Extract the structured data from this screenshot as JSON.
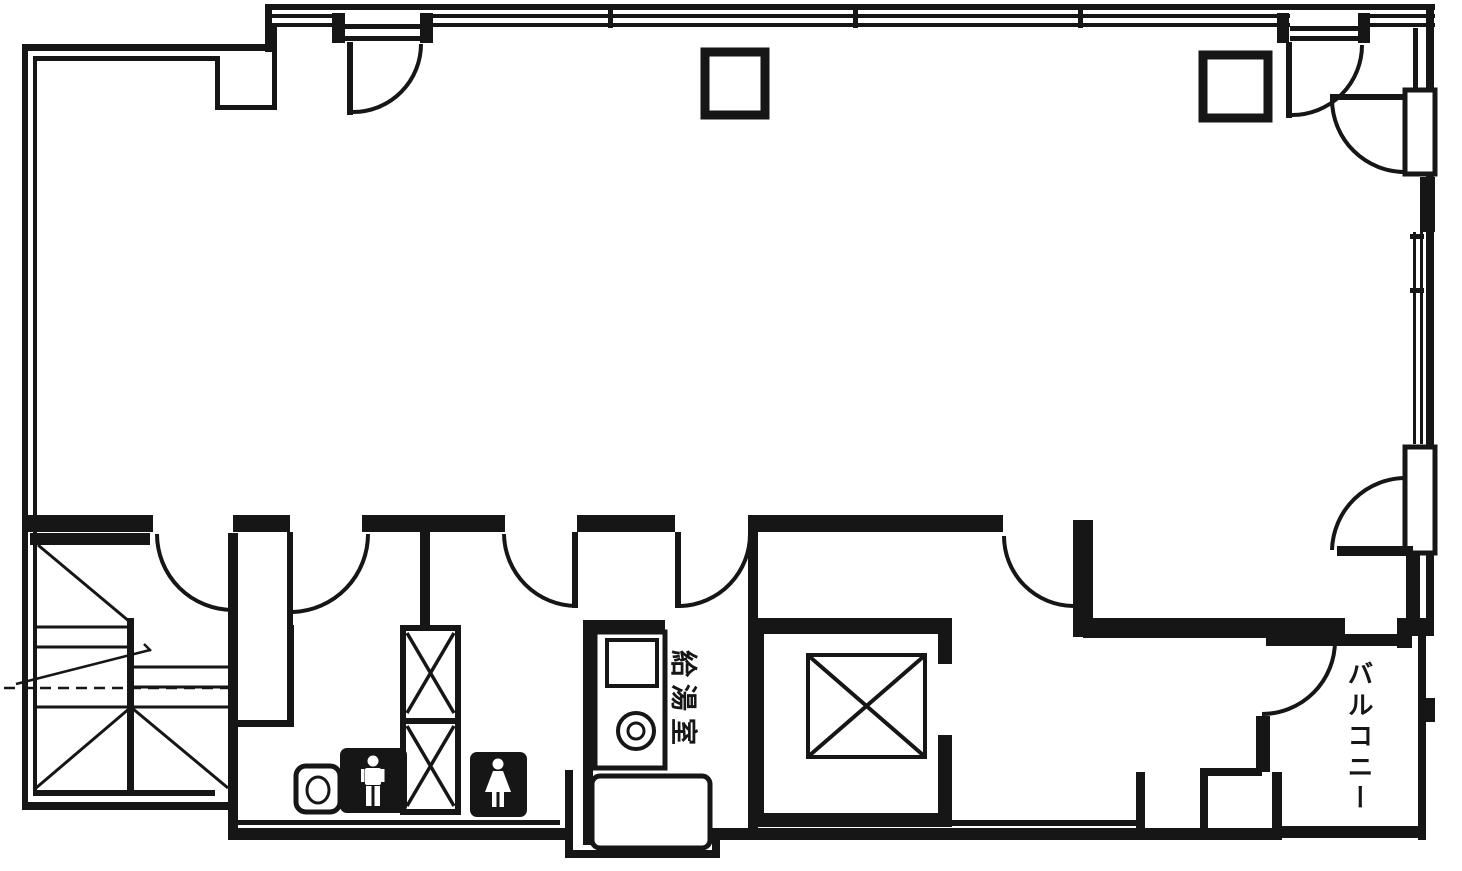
{
  "plan": {
    "kind": "architectural-floor-plan-scan",
    "labels": {
      "kitchenette": "給湯室",
      "balcony": "バルコニー"
    },
    "icons": {
      "male_restroom": "male-pictogram",
      "female_restroom": "female-pictogram",
      "elevator": "elevator-x-symbol",
      "pipe_shaft": "shaft-x-symbol",
      "stairs": "stair-flights-with-landing",
      "doors": "door-swing-arc",
      "toilet_fixture": "toilet-bowl-outline"
    },
    "colors": {
      "ink": "#161616",
      "paper": "#ffffff"
    }
  }
}
